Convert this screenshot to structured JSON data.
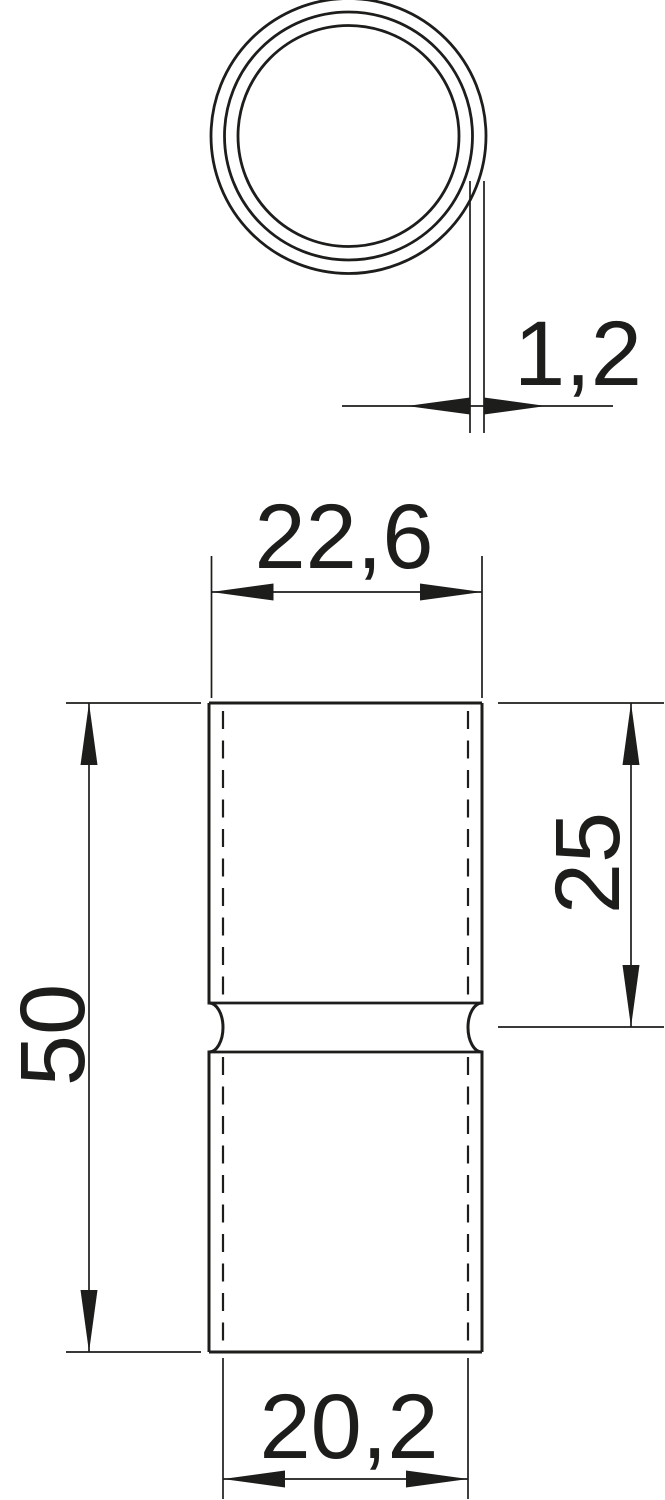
{
  "page": {
    "background": "#ffffff"
  },
  "drawing": {
    "kind": "technical-dimension-drawing",
    "part": "tube-sleeve-coupler",
    "line_color": "#1d1d1b",
    "views": {
      "top": {
        "name": "cross-section-view",
        "shape": "three-concentric-circles"
      },
      "front": {
        "name": "front-view",
        "shape": "tube-with-center-bead"
      }
    },
    "dimensions": {
      "wall_thickness": "1,2",
      "outer_width": "22,6",
      "upper_half_length": "25",
      "total_length": "50",
      "inner_width": "20,2"
    }
  }
}
